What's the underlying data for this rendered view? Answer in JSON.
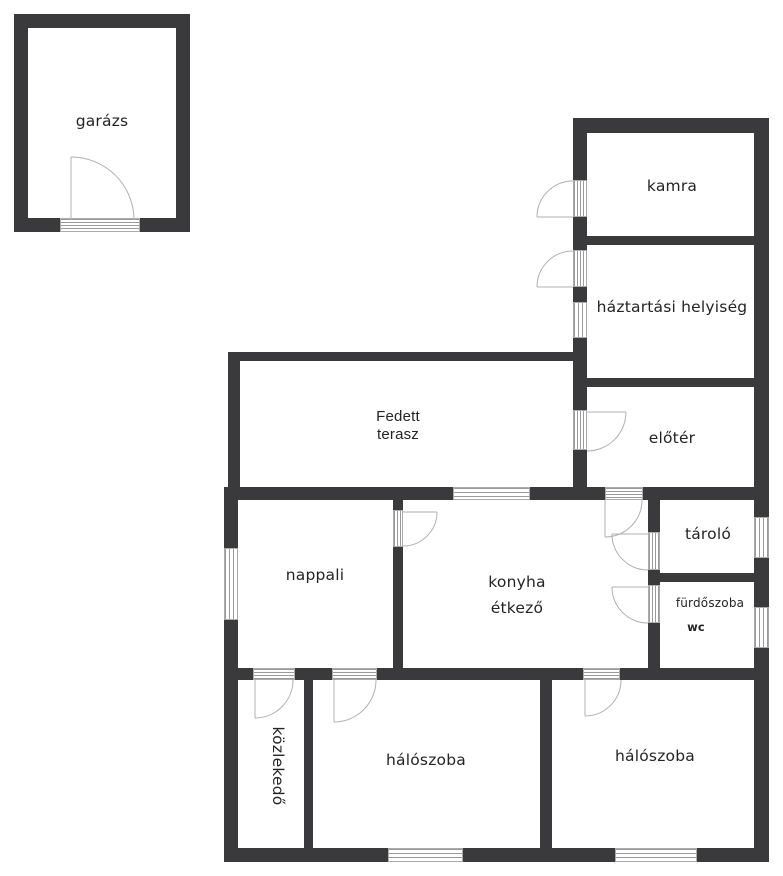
{
  "diagram_type": "floor-plan",
  "language": "Hungarian",
  "colors": {
    "wall": "#3a3a3c",
    "background": "#ffffff",
    "door_arc": "#b0b0b0",
    "window_stripe": "#9a9a9a",
    "label_text": "#242424"
  },
  "rooms": {
    "garage": {
      "label": "garázs"
    },
    "pantry": {
      "label": "kamra"
    },
    "utility": {
      "label": "háztartási helyiség"
    },
    "foyer": {
      "label": "előtér"
    },
    "terrace": {
      "line1": "Fedett",
      "line2": "terasz"
    },
    "living": {
      "label": "nappali"
    },
    "kitchen": {
      "line1": "konyha",
      "line2": "étkező"
    },
    "storage": {
      "label": "tároló"
    },
    "bathroom": {
      "label": "fürdőszoba",
      "sublabel": "wc"
    },
    "hallway": {
      "label": "közlekedő"
    },
    "bedroom1": {
      "label": "hálószoba"
    },
    "bedroom2": {
      "label": "hálószoba"
    }
  }
}
